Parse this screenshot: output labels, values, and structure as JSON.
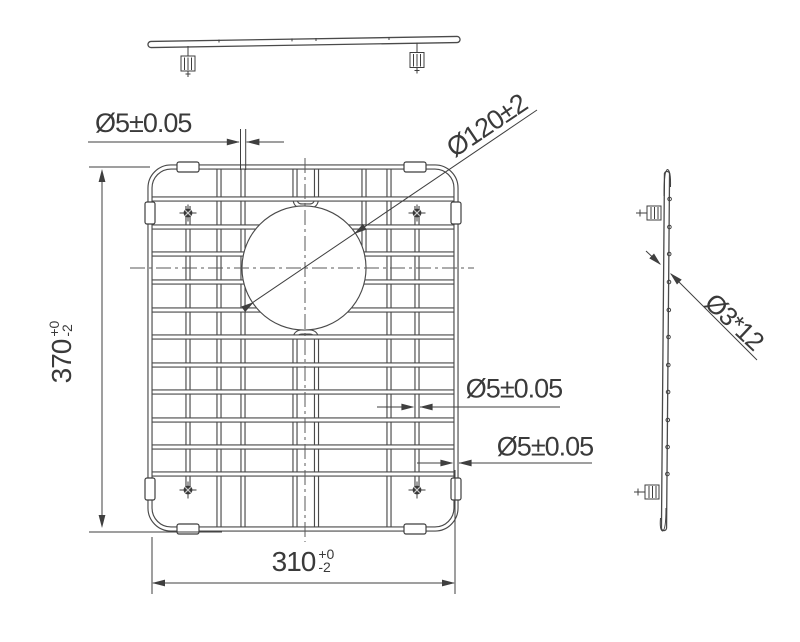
{
  "drawing": {
    "dimensions": {
      "top_wire": "Ø5±0.05",
      "hole": "Ø120±2",
      "height": {
        "value": "370",
        "tol_plus": "+0",
        "tol_minus": "-2"
      },
      "width": {
        "value": "310",
        "tol_plus": "+0",
        "tol_minus": "-2"
      },
      "mid_wire": "Ø5±0.05",
      "edge_wire": "Ø5±0.05",
      "cross_wires": "Ø3*12"
    },
    "colors": {
      "line": "#4a4a4a",
      "dimension": "#3f3f3f",
      "text": "#3a3a3a",
      "background": "#ffffff"
    }
  }
}
